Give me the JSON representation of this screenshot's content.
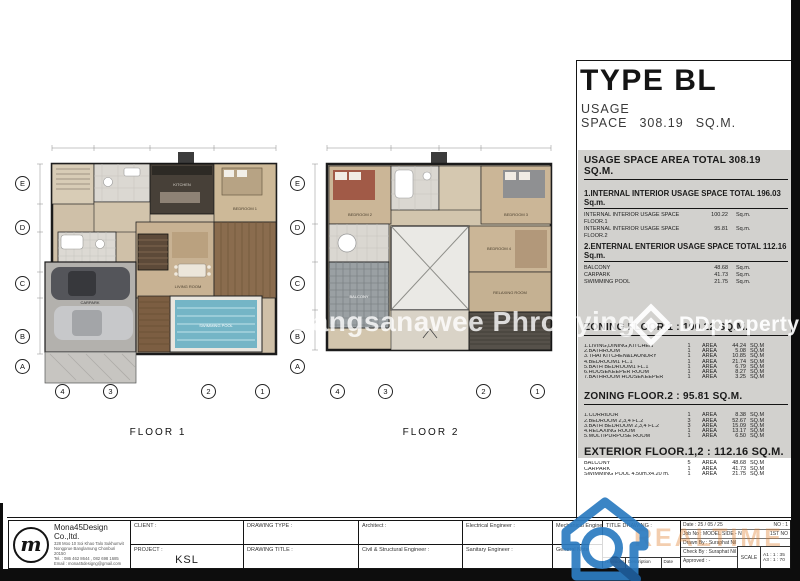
{
  "header": {
    "type_title": "TYPE BL",
    "usage_space_label": "USAGE SPACE",
    "usage_space_value": "308.19",
    "usage_space_unit": "SQ.M."
  },
  "labels": {
    "area": "AREA",
    "sqm": "SQ.M",
    "sqm_dot": "Sq.m."
  },
  "summary": {
    "total_heading": "USAGE SPACE AREA TOTAL 308.19 SQ.M.",
    "internal_heading": "1.INTERNAL INTERIOR USAGE SPACE TOTAL 196.03 Sq.m.",
    "internal_rows": [
      {
        "label": "INTERNAL INTERIOR USAGE SPACE FLOOR.1",
        "value": "100.22"
      },
      {
        "label": "INTERNAL INTERIOR USAGE SPACE FLOOR.2",
        "value": "95.81"
      }
    ],
    "external_heading": "2.ENTERNAL ENTERIOR USAGE SPACE TOTAL 112.16 Sq.m.",
    "external_rows": [
      {
        "label": "BALCONY",
        "value": "48.68"
      },
      {
        "label": "CARPARK",
        "value": "41.73"
      },
      {
        "label": "SWIMMING POOL",
        "value": "21.75"
      }
    ]
  },
  "zoning_floor1": {
    "heading": "ZONING FLOOR.1 : 100.22 SQ.M.",
    "rows": [
      {
        "label": "1.LIVING,DINING,KITCHEN",
        "qty": "1",
        "value": "44.24"
      },
      {
        "label": "2.BATHROOM",
        "qty": "1",
        "value": "5.08"
      },
      {
        "label": "3.THAI KITCHEN&LAUNDRY",
        "qty": "1",
        "value": "10.85"
      },
      {
        "label": "4.BEDROOM1 FL.1",
        "qty": "1",
        "value": "21.74"
      },
      {
        "label": "5.BATH BEDROOM1 FL.1",
        "qty": "1",
        "value": "6.79"
      },
      {
        "label": "6.HOUSEKEEPER ROOM",
        "qty": "1",
        "value": "8.27"
      },
      {
        "label": "7.BATHROOM HOUSEKEEPER",
        "qty": "1",
        "value": "3.25"
      }
    ]
  },
  "zoning_floor2": {
    "heading": "ZONING FLOOR.2 : 95.81 SQ.M.",
    "rows": [
      {
        "label": "1.CORRIDOR",
        "qty": "1",
        "value": "8.38"
      },
      {
        "label": "2.BEDROOM 2,3,4 FL.2",
        "qty": "3",
        "value": "52.67"
      },
      {
        "label": "3.BATH BEDROOM 2,3,4 FL.2",
        "qty": "3",
        "value": "15.09"
      },
      {
        "label": "4.RELAXING ROOM",
        "qty": "1",
        "value": "13.17"
      },
      {
        "label": "5.MULTIPURPOSE ROOM",
        "qty": "1",
        "value": "6.50"
      }
    ]
  },
  "exterior": {
    "heading": "EXTERIOR FLOOR.1,2 : 112.16 SQ.M.",
    "rows": [
      {
        "label": "BALCONY",
        "qty": "5",
        "value": "48.68"
      },
      {
        "label": "CARPARK",
        "qty": "1",
        "value": "41.73"
      },
      {
        "label": "SWIMMING POOL 4.50m.x4.20 m.",
        "qty": "1",
        "value": "21.75"
      }
    ]
  },
  "plans": {
    "floor1_label": "FLOOR 1",
    "floor2_label": "FLOOR 2",
    "row_bubbles": [
      "E",
      "D",
      "C",
      "B",
      "A"
    ],
    "col_bubbles": [
      "4",
      "3",
      "2",
      "1"
    ],
    "floor1_rooms": {
      "living": "LIVING ROOM",
      "kitchen": "KITCHEN",
      "bedroom1": "BEDROOM 1",
      "carpark": "CARPARK",
      "pool": "SWIMMING POOL"
    },
    "floor2_rooms": {
      "bedroom2": "BEDROOM 2",
      "bedroom3": "BEDROOM 3",
      "bedroom4": "BEDROOM 4",
      "relaxing": "RELAXING ROOM",
      "balcony": "BALCONY"
    }
  },
  "watermarks": {
    "agent": "Bangsanawee Phrohying",
    "brand": "DDproperty",
    "bottom_brand": "REALTIME"
  },
  "title_block": {
    "company": "Mona45Design Co.,ltd.",
    "logo_glyph": "m",
    "address_line1": "328 Moo 10 Soi Khao Talo Sukhumvit",
    "address_line2": "Nongprue Banglamung Chonburi 20150",
    "address_line3": "Tel. : 086 462 8644 , 082 698 1685",
    "address_line4": "Email : mona45designg@gmail.com",
    "client_label": "CLIENT :",
    "project_label": "PROJECT :",
    "project_value": "KSL",
    "drawing_type_label": "DRAWING TYPE :",
    "drawing_title_label": "DRAWING TITLE :",
    "architect_label": "Architect :",
    "civil_label": "Civil & Structural Engineer :",
    "electrical_label": "Electrical Engineer :",
    "sanitary_label": "Sanitary Engineer :",
    "mechanical_label": "Mechanical Engineer :",
    "general_note_label": "General Note :",
    "title_drawing_label": "TITLE DRAWING :",
    "revisions_label": "Revisions",
    "description_label": "Description",
    "date_col_label": "Date",
    "date_field": "Date : 25 / 05 / 25",
    "no_field": "NO : 1",
    "job_field": "Job No : MODEL SIDE - N",
    "sheet_field": "1ST NO",
    "drawn_by": "Drawn By : Suraphat Nil",
    "check_by": "Check By : Suraphat Nil",
    "approved": "Approved : -",
    "scale_label": "SCALE",
    "scale_a1": "A1 : 1 : 35",
    "scale_a3": "A3 : 1 : 70"
  }
}
